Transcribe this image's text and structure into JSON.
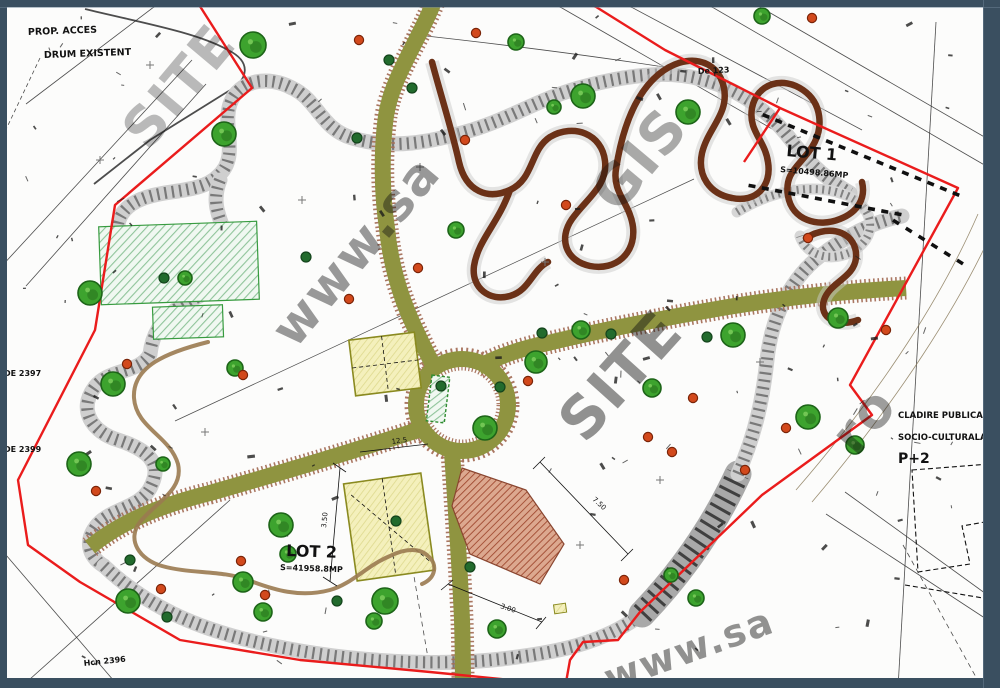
{
  "window": {
    "frame_color": "#3a4f60",
    "frame_highlight": "#6e8496",
    "background": "#fcfcfb"
  },
  "labels": {
    "top_left_line1": "PROP. ACCES",
    "top_left_line2": "DRUM EXISTENT",
    "lot1_title": "LOT 1",
    "lot1_area": "S=10498.86MP",
    "lot2_title": "LOT 2",
    "lot2_area": "S=41958.8MP",
    "right_block_line1": "CLADIRE PUBLICA",
    "right_block_line2": "SOCIO-CULTURALA",
    "right_block_line3": "P+2"
  },
  "map": {
    "colors": {
      "boundary": "#ea1c1c",
      "road_olive": "#8f9440",
      "road_stipple": "#a5705a",
      "path_gray": "#cfcfcf",
      "track_brown": "#6b3117",
      "tree_fill": "#3da32e",
      "tree_edge": "#1d6418",
      "bush": "#226b2d",
      "fruit": "#d2491c",
      "watermark": "#9a9a9a",
      "building_yellow": "#f2eeb6",
      "terracotta": "#b06048",
      "hatch_green": "#8fc49a"
    },
    "watermarks": [
      {
        "text": "SITE",
        "x": 148,
        "y": 152,
        "rot": -50,
        "size": 54,
        "op": 0.28
      },
      {
        "text": "www.sa",
        "x": 295,
        "y": 350,
        "rot": -50,
        "size": 50,
        "op": 0.42
      },
      {
        "text": "SITE",
        "x": 585,
        "y": 445,
        "rot": -48,
        "size": 58,
        "op": 0.45
      },
      {
        "text": "GIS",
        "x": 618,
        "y": 215,
        "rot": -50,
        "size": 56,
        "op": 0.35
      },
      {
        "text": "ro",
        "x": 856,
        "y": 458,
        "rot": -50,
        "size": 54,
        "op": 0.4
      },
      {
        "text": "www.sa",
        "x": 610,
        "y": 692,
        "rot": -20,
        "size": 38,
        "op": 0.45
      }
    ],
    "edge_labels": [
      {
        "text": "DE 2397",
        "x": 4,
        "y": 376,
        "rot": 0
      },
      {
        "text": "DE 2399",
        "x": 4,
        "y": 452,
        "rot": 0
      },
      {
        "text": "Hcn 2396",
        "x": 84,
        "y": 666,
        "rot": -6
      },
      {
        "text": "De 123",
        "x": 698,
        "y": 74,
        "rot": -3
      }
    ],
    "dim_labels": [
      {
        "text": "7.50",
        "x": 592,
        "y": 500,
        "rot": 42
      },
      {
        "text": "3.00",
        "x": 500,
        "y": 608,
        "rot": 18
      },
      {
        "text": "3.50",
        "x": 326,
        "y": 528,
        "rot": -84
      },
      {
        "text": "12.5",
        "x": 392,
        "y": 444,
        "rot": -8
      }
    ],
    "trees": [
      [
        253,
        45,
        13
      ],
      [
        516,
        42,
        8
      ],
      [
        583,
        96,
        12
      ],
      [
        554,
        107,
        7
      ],
      [
        688,
        112,
        12
      ],
      [
        224,
        134,
        12
      ],
      [
        762,
        16,
        8
      ],
      [
        90,
        293,
        12
      ],
      [
        113,
        384,
        12
      ],
      [
        79,
        464,
        12
      ],
      [
        235,
        368,
        8
      ],
      [
        163,
        464,
        7
      ],
      [
        185,
        278,
        7
      ],
      [
        536,
        362,
        11
      ],
      [
        581,
        330,
        9
      ],
      [
        485,
        428,
        12
      ],
      [
        456,
        230,
        8
      ],
      [
        733,
        335,
        12
      ],
      [
        808,
        417,
        12
      ],
      [
        838,
        318,
        10
      ],
      [
        855,
        445,
        9
      ],
      [
        281,
        525,
        12
      ],
      [
        128,
        601,
        12
      ],
      [
        243,
        582,
        10
      ],
      [
        263,
        612,
        9
      ],
      [
        385,
        601,
        13
      ],
      [
        497,
        629,
        9
      ],
      [
        374,
        621,
        8
      ],
      [
        288,
        554,
        8
      ],
      [
        652,
        388,
        9
      ],
      [
        696,
        598,
        8
      ],
      [
        671,
        575,
        7
      ]
    ],
    "bushes": [
      [
        164,
        278
      ],
      [
        306,
        257
      ],
      [
        357,
        138
      ],
      [
        542,
        333
      ],
      [
        611,
        334
      ],
      [
        500,
        387
      ],
      [
        441,
        386
      ],
      [
        707,
        337
      ],
      [
        470,
        567
      ],
      [
        337,
        601
      ],
      [
        396,
        521
      ],
      [
        167,
        617
      ],
      [
        130,
        560
      ],
      [
        412,
        88
      ],
      [
        389,
        60
      ]
    ],
    "fruit_dots": [
      [
        359,
        40
      ],
      [
        476,
        33
      ],
      [
        812,
        18
      ],
      [
        648,
        437
      ],
      [
        672,
        452
      ],
      [
        693,
        398
      ],
      [
        745,
        470
      ],
      [
        786,
        428
      ],
      [
        528,
        381
      ],
      [
        465,
        140
      ],
      [
        418,
        268
      ],
      [
        349,
        299
      ],
      [
        241,
        561
      ],
      [
        265,
        595
      ],
      [
        161,
        589
      ],
      [
        96,
        491
      ],
      [
        127,
        364
      ],
      [
        243,
        375
      ],
      [
        886,
        330
      ],
      [
        808,
        238
      ],
      [
        566,
        205
      ],
      [
        624,
        580
      ]
    ],
    "crosses": [
      [
        150,
        65
      ],
      [
        302,
        200
      ],
      [
        545,
        262
      ],
      [
        420,
        167
      ],
      [
        205,
        432
      ],
      [
        580,
        545
      ],
      [
        100,
        160
      ],
      [
        760,
        362
      ],
      [
        660,
        480
      ]
    ],
    "dash_rows": [
      {
        "x1": 766,
        "y1": 116,
        "x2": 956,
        "y2": 194,
        "n": 16
      },
      {
        "x1": 752,
        "y1": 186,
        "x2": 898,
        "y2": 214,
        "n": 12
      },
      {
        "x1": 896,
        "y1": 222,
        "x2": 960,
        "y2": 262,
        "n": 6
      }
    ]
  }
}
